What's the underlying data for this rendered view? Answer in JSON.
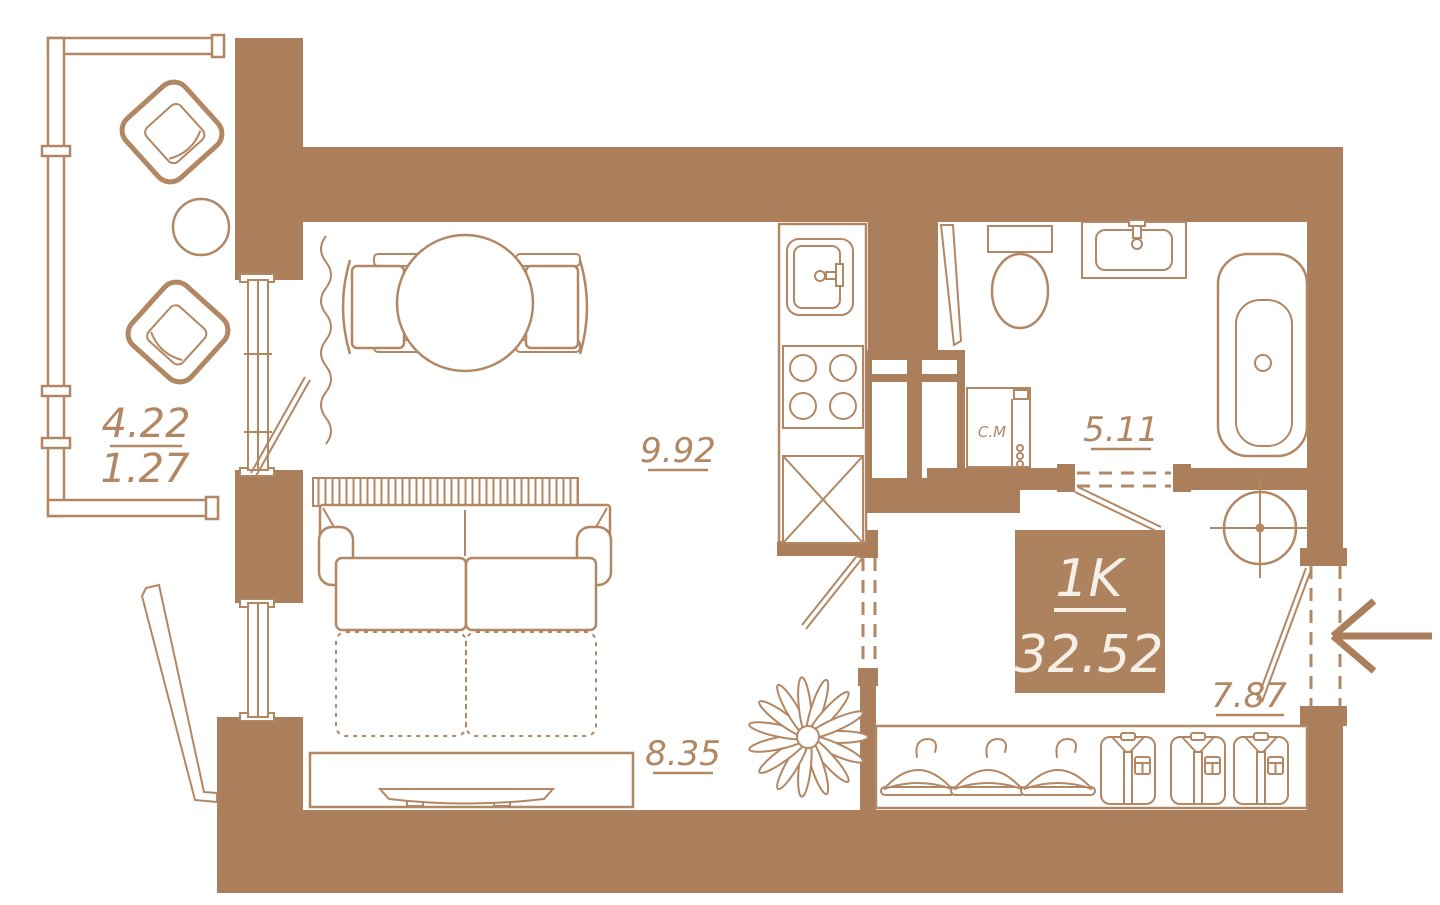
{
  "plan": {
    "unit": {
      "type": "1K",
      "total_area": "32.52"
    },
    "rooms": {
      "balcony": {
        "area": "4.22",
        "area_reduced": "1.27"
      },
      "kitchen": {
        "area": "9.92"
      },
      "bathroom": {
        "area": "5.11"
      },
      "living_room": {
        "area": "8.35"
      },
      "hallway": {
        "area": "7.87"
      }
    },
    "labels": {
      "washing_machine": "С.М"
    },
    "colors": {
      "wall_fill": "#ab7e5c",
      "line": "#b28764",
      "unit_box_fill": "#ad825f",
      "unit_box_text": "#f6efe6",
      "background": "#ffffff"
    }
  }
}
